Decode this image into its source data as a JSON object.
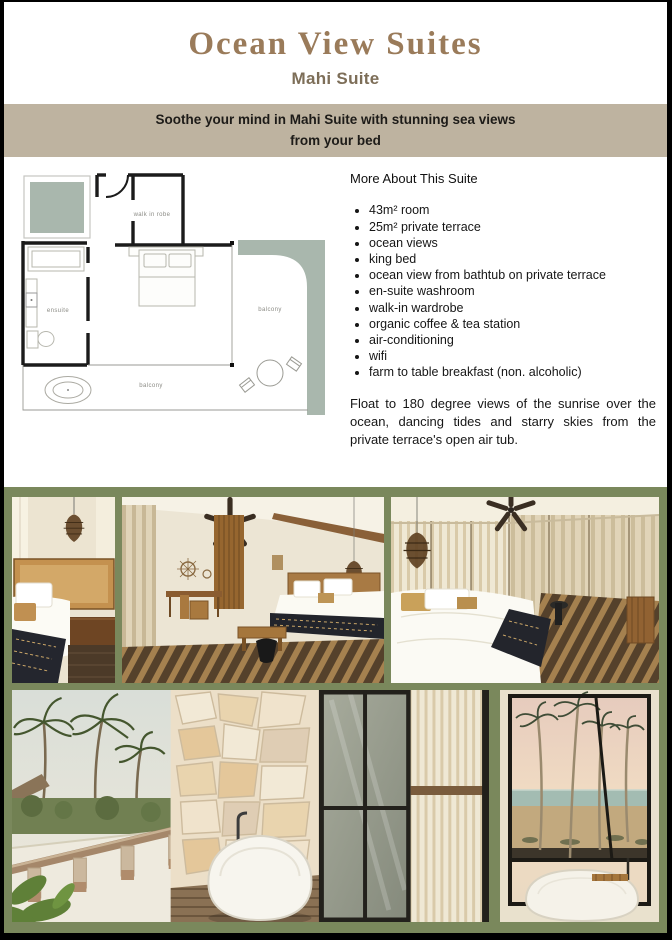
{
  "page": {
    "title": "Ocean View Suites",
    "subtitle": "Mahi Suite",
    "banner": "Soothe your mind in Mahi Suite with stunning sea views from your bed"
  },
  "floor_plan": {
    "labels": {
      "walk_in_robe": "walk in robe",
      "ensuite": "ensuite",
      "balcony_right": "balcony",
      "balcony_bottom": "balcony"
    }
  },
  "details": {
    "heading": "More About This Suite",
    "bullets": [
      "43m² room",
      "25m² private terrace",
      "ocean views",
      "king bed",
      "ocean view from bathtub on private terrace",
      "en-suite washroom",
      "walk-in wardrobe",
      "organic coffee & tea station",
      "air-conditioning",
      "wifi",
      "farm to table breakfast (non. alcoholic)"
    ],
    "paragraph": "Float to 180 degree views of the sunrise over the ocean, dancing tides and starry skies from the private terrace's open air tub."
  },
  "colors": {
    "title_accent": "#9a7b5a",
    "subtitle": "#7d6e58",
    "banner_bg": "#beb3a0",
    "gallery_bg": "#7a885c",
    "plan_sage": "#a9b7ad",
    "plan_wall": "#1b1b1b",
    "page_border": "#000000"
  }
}
